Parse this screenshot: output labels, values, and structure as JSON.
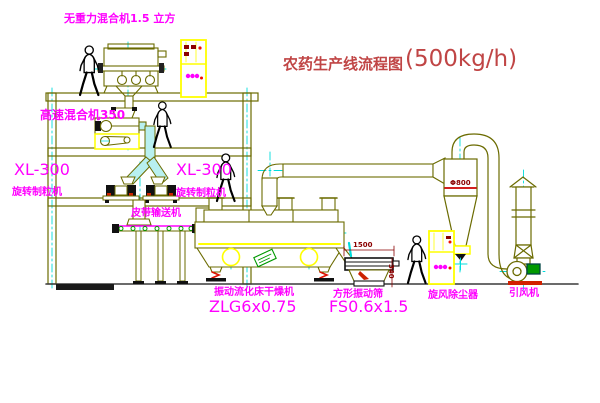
{
  "title": {
    "text": "农药生产线流程图",
    "capacity": "(500kg/h)"
  },
  "equipment_labels": {
    "gravity_mixer": "无重力混合机1.5 立方",
    "high_speed_mixer": "高速混合机350",
    "granulator_left": {
      "model": "XL-300",
      "name": "旋转制粒机"
    },
    "granulator_right": {
      "model": "XL-300",
      "name": "旋转制粒机"
    },
    "belt_conveyor": "皮带输送机",
    "dryer": {
      "name": "振动流化床干燥机",
      "model": "ZLG6x0.75"
    },
    "screen": {
      "name": "方形振动筛",
      "model": "FS0.6x1.5"
    },
    "cyclone": "旋风除尘器",
    "fan": "引风机"
  },
  "dimensions": {
    "cyclone_diameter": "Φ800",
    "screen_length": "1500",
    "screen_height": "340"
  },
  "colors": {
    "equipment_line": "#6b6b00",
    "centerline_cyan": "#00dcdc",
    "label_magenta": "#ff00ff",
    "title_red": "#c04545",
    "dimension_red": "#8b0000",
    "cabinet_yellow": "#ffff00",
    "motor_green": "#009900",
    "alert_red": "#dd1100"
  }
}
